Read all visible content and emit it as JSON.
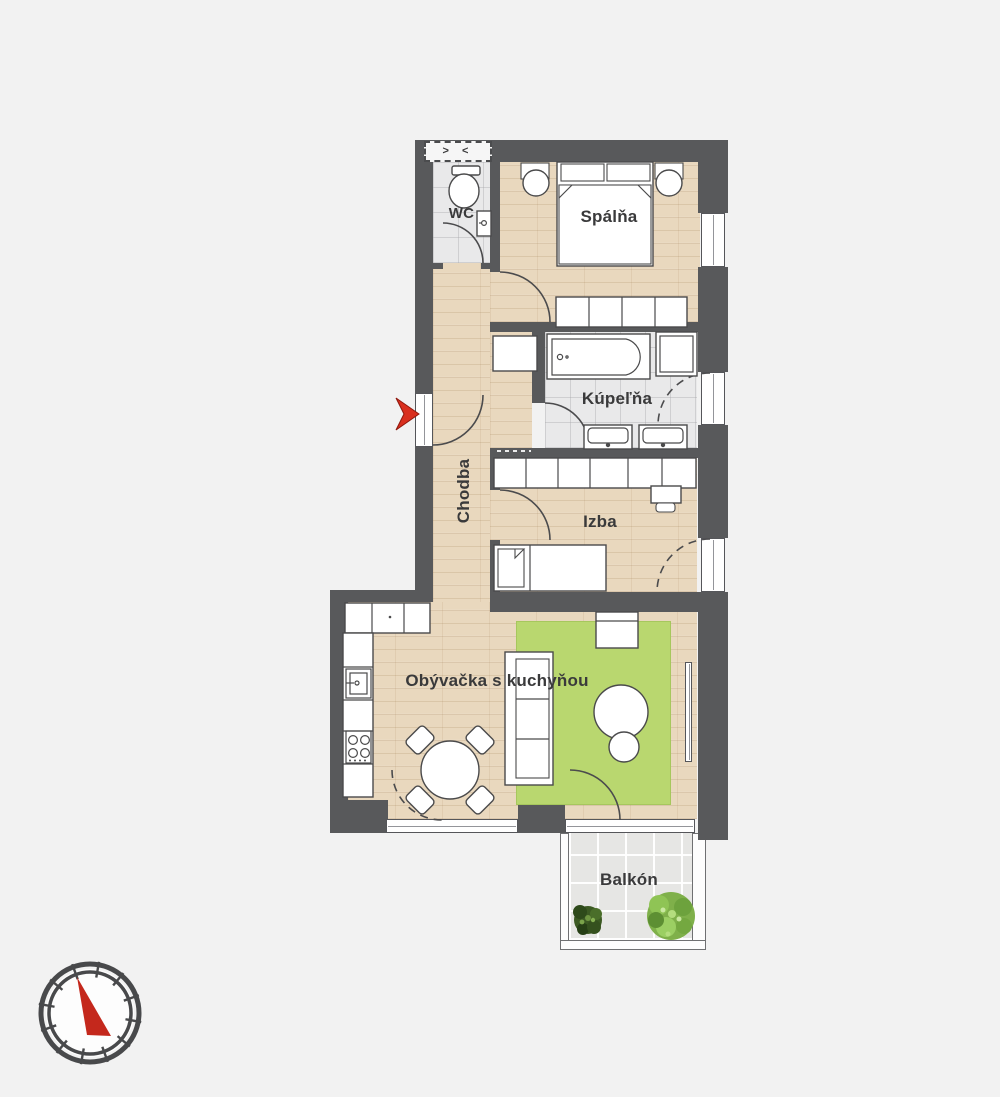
{
  "background_color": "#f2f2f2",
  "rooms": {
    "wc": {
      "label": "WC"
    },
    "spalna": {
      "label": "Spálňa"
    },
    "kupelna": {
      "label": "Kúpeľňa"
    },
    "chodba": {
      "label": "Chodba"
    },
    "izba": {
      "label": "Izba"
    },
    "obyvacka": {
      "label": "Obývačka s kuchyňou"
    },
    "balkon": {
      "label": "Balkón"
    }
  },
  "markers": {
    "shaft_symbol": "> <",
    "entrance_arrow_color": "#d92f1e",
    "compass_needle_color": "#c4281c"
  },
  "colors": {
    "wall": "#58595b",
    "wood_floor": "#e9d8be",
    "tile_floor": "#e9e9ea",
    "rug": "#b9d76f",
    "furniture_outline": "#4a4a4b",
    "label_text": "#3a3a3b"
  }
}
